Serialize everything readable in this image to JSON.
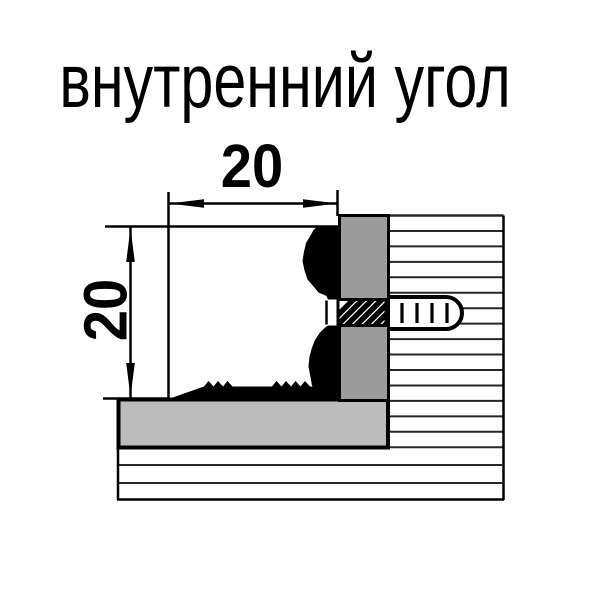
{
  "title": "внутренний угол",
  "diagram": {
    "dimension_width_label": "20",
    "dimension_height_label": "20",
    "colors": {
      "background": "#ffffff",
      "line": "#000000",
      "mounting_flange_gray": "#9b9b9b",
      "base_bar_gray": "#bcbcbc"
    }
  }
}
